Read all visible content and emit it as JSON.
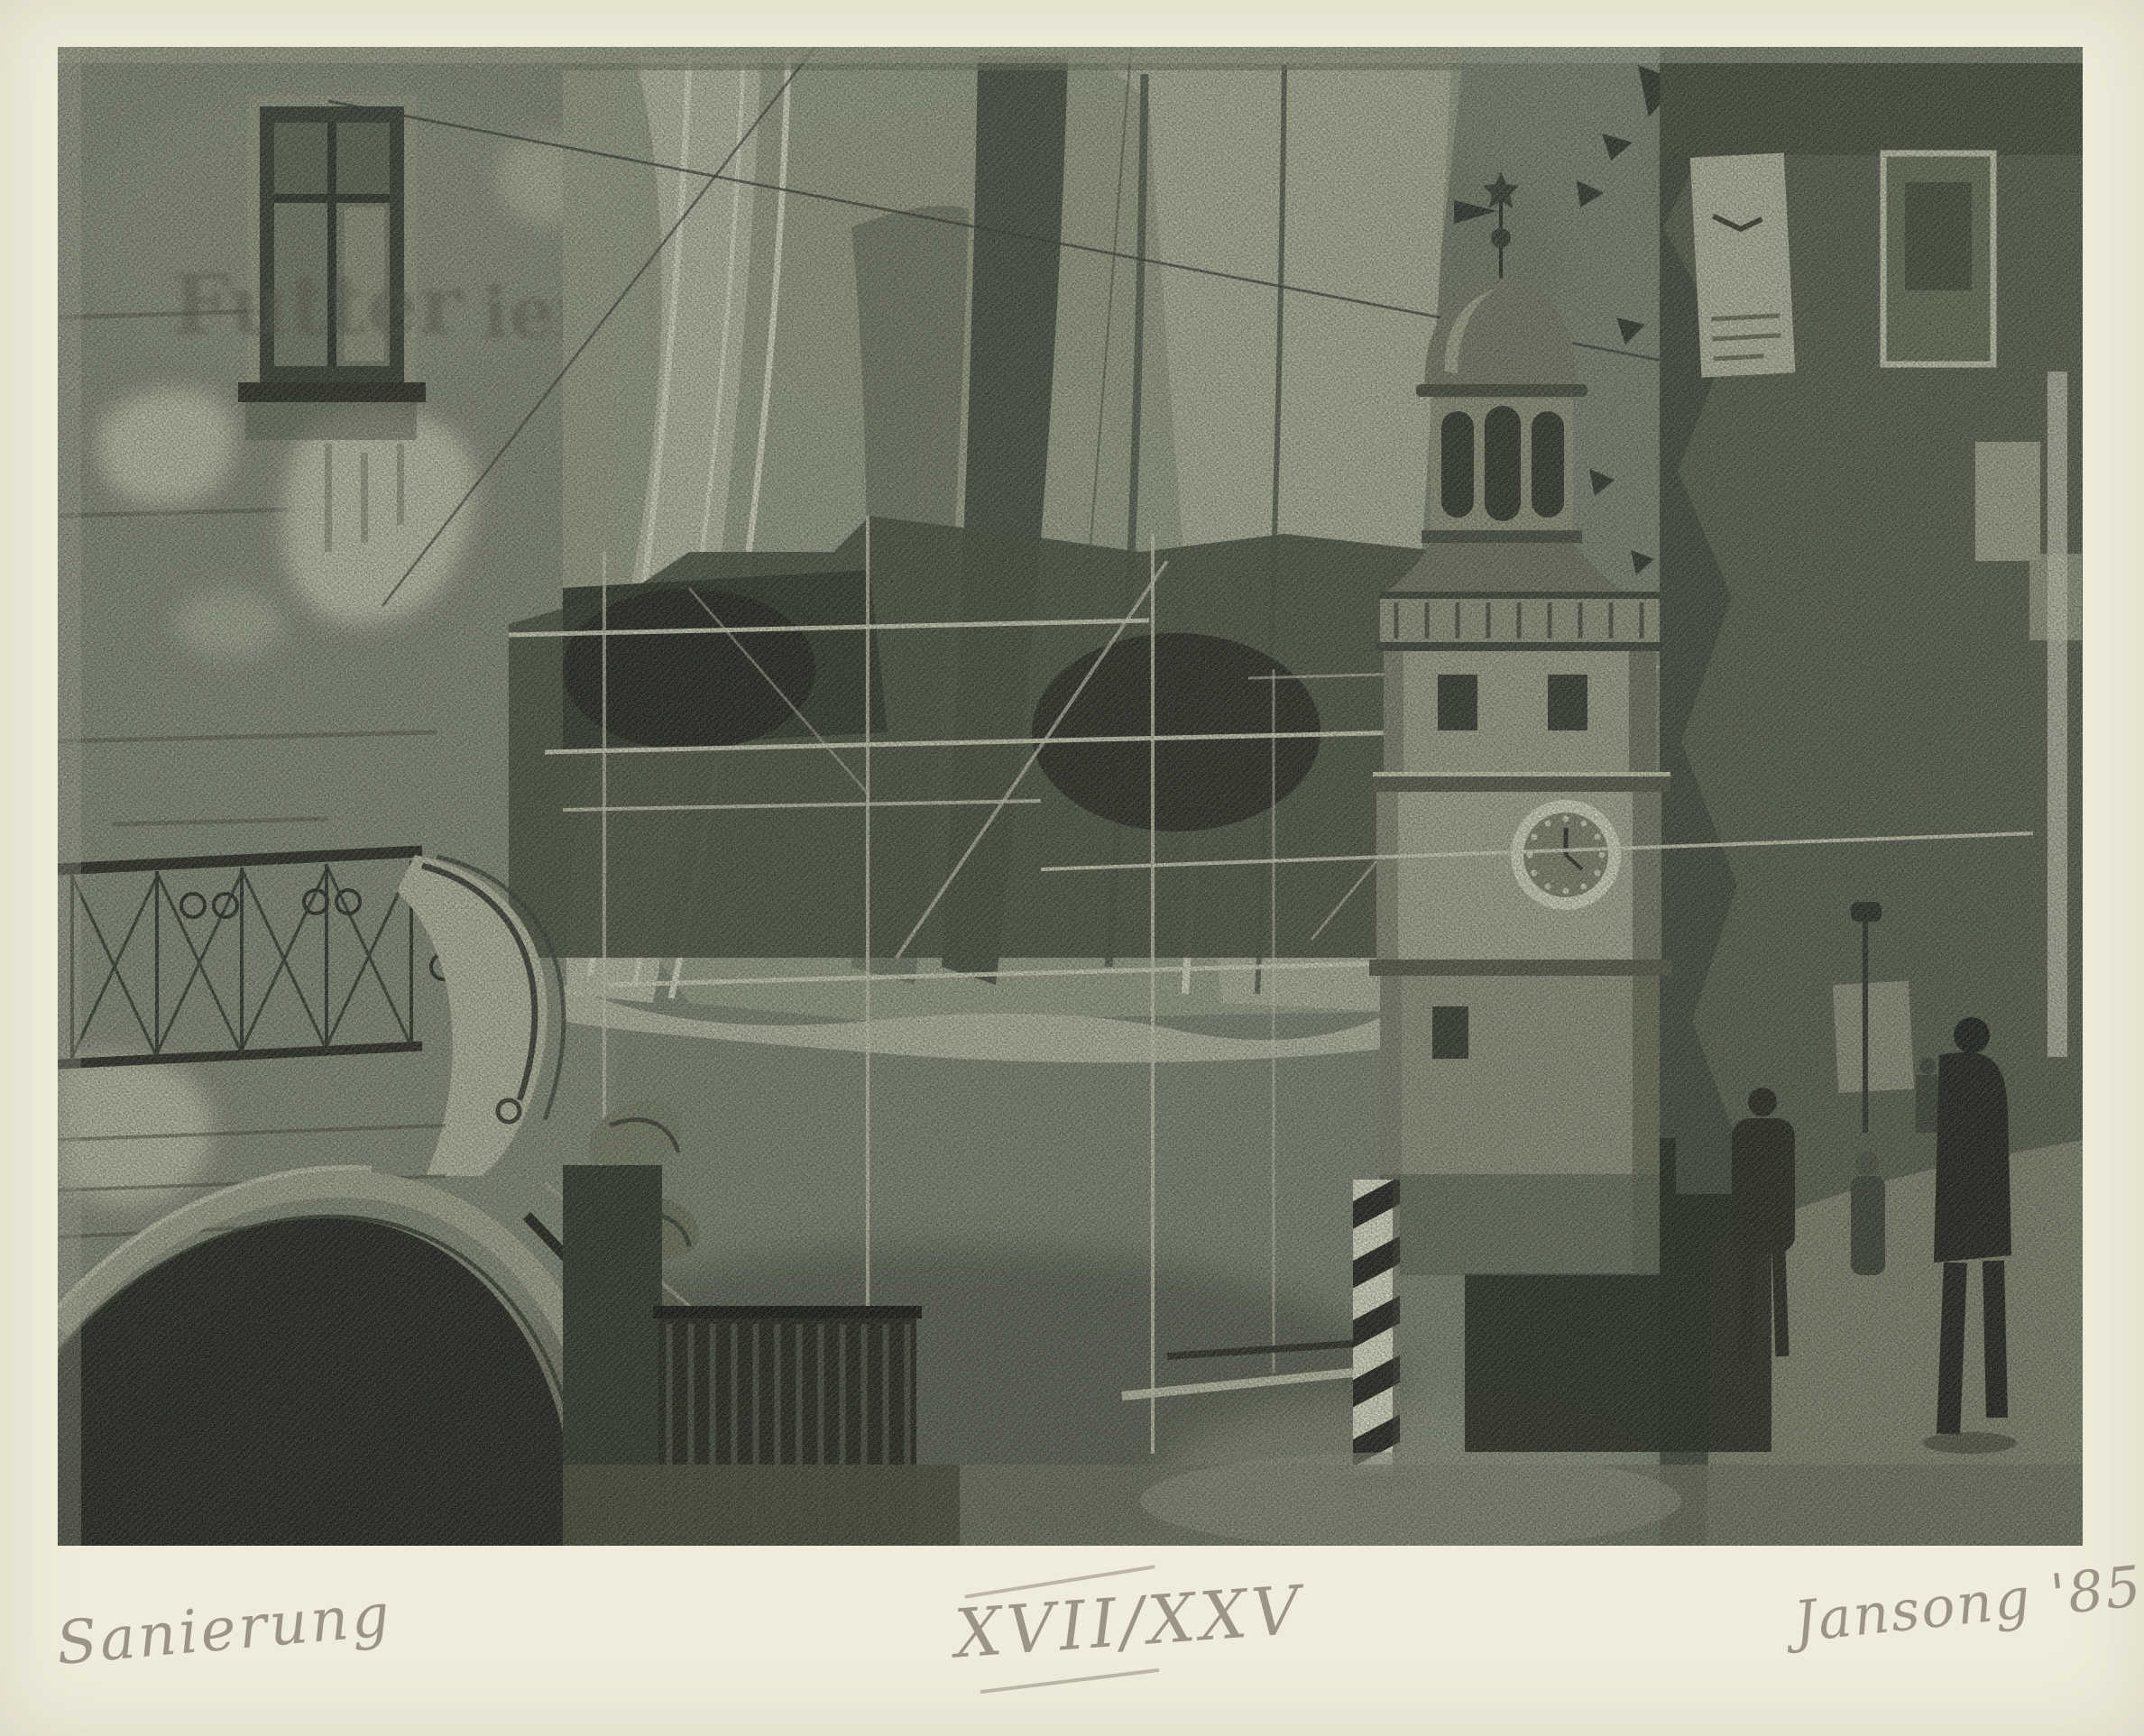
{
  "artwork": {
    "inscriptions": {
      "title": "Sanierung",
      "edition": "XVII/XXV",
      "signature": "Jansong '85"
    },
    "ghost_sign": {
      "left_fragment": "Futter",
      "right_fragment": "ier"
    },
    "palette": {
      "paper": "#f0ecdb",
      "ink_darkest": "#20251c",
      "ink_dark": "#3d4438",
      "ink_mid": "#7d8573",
      "ink_light": "#b9bfa8",
      "ink_highlight": "#d6d9c2",
      "pencil": "#8f8a7c"
    }
  }
}
